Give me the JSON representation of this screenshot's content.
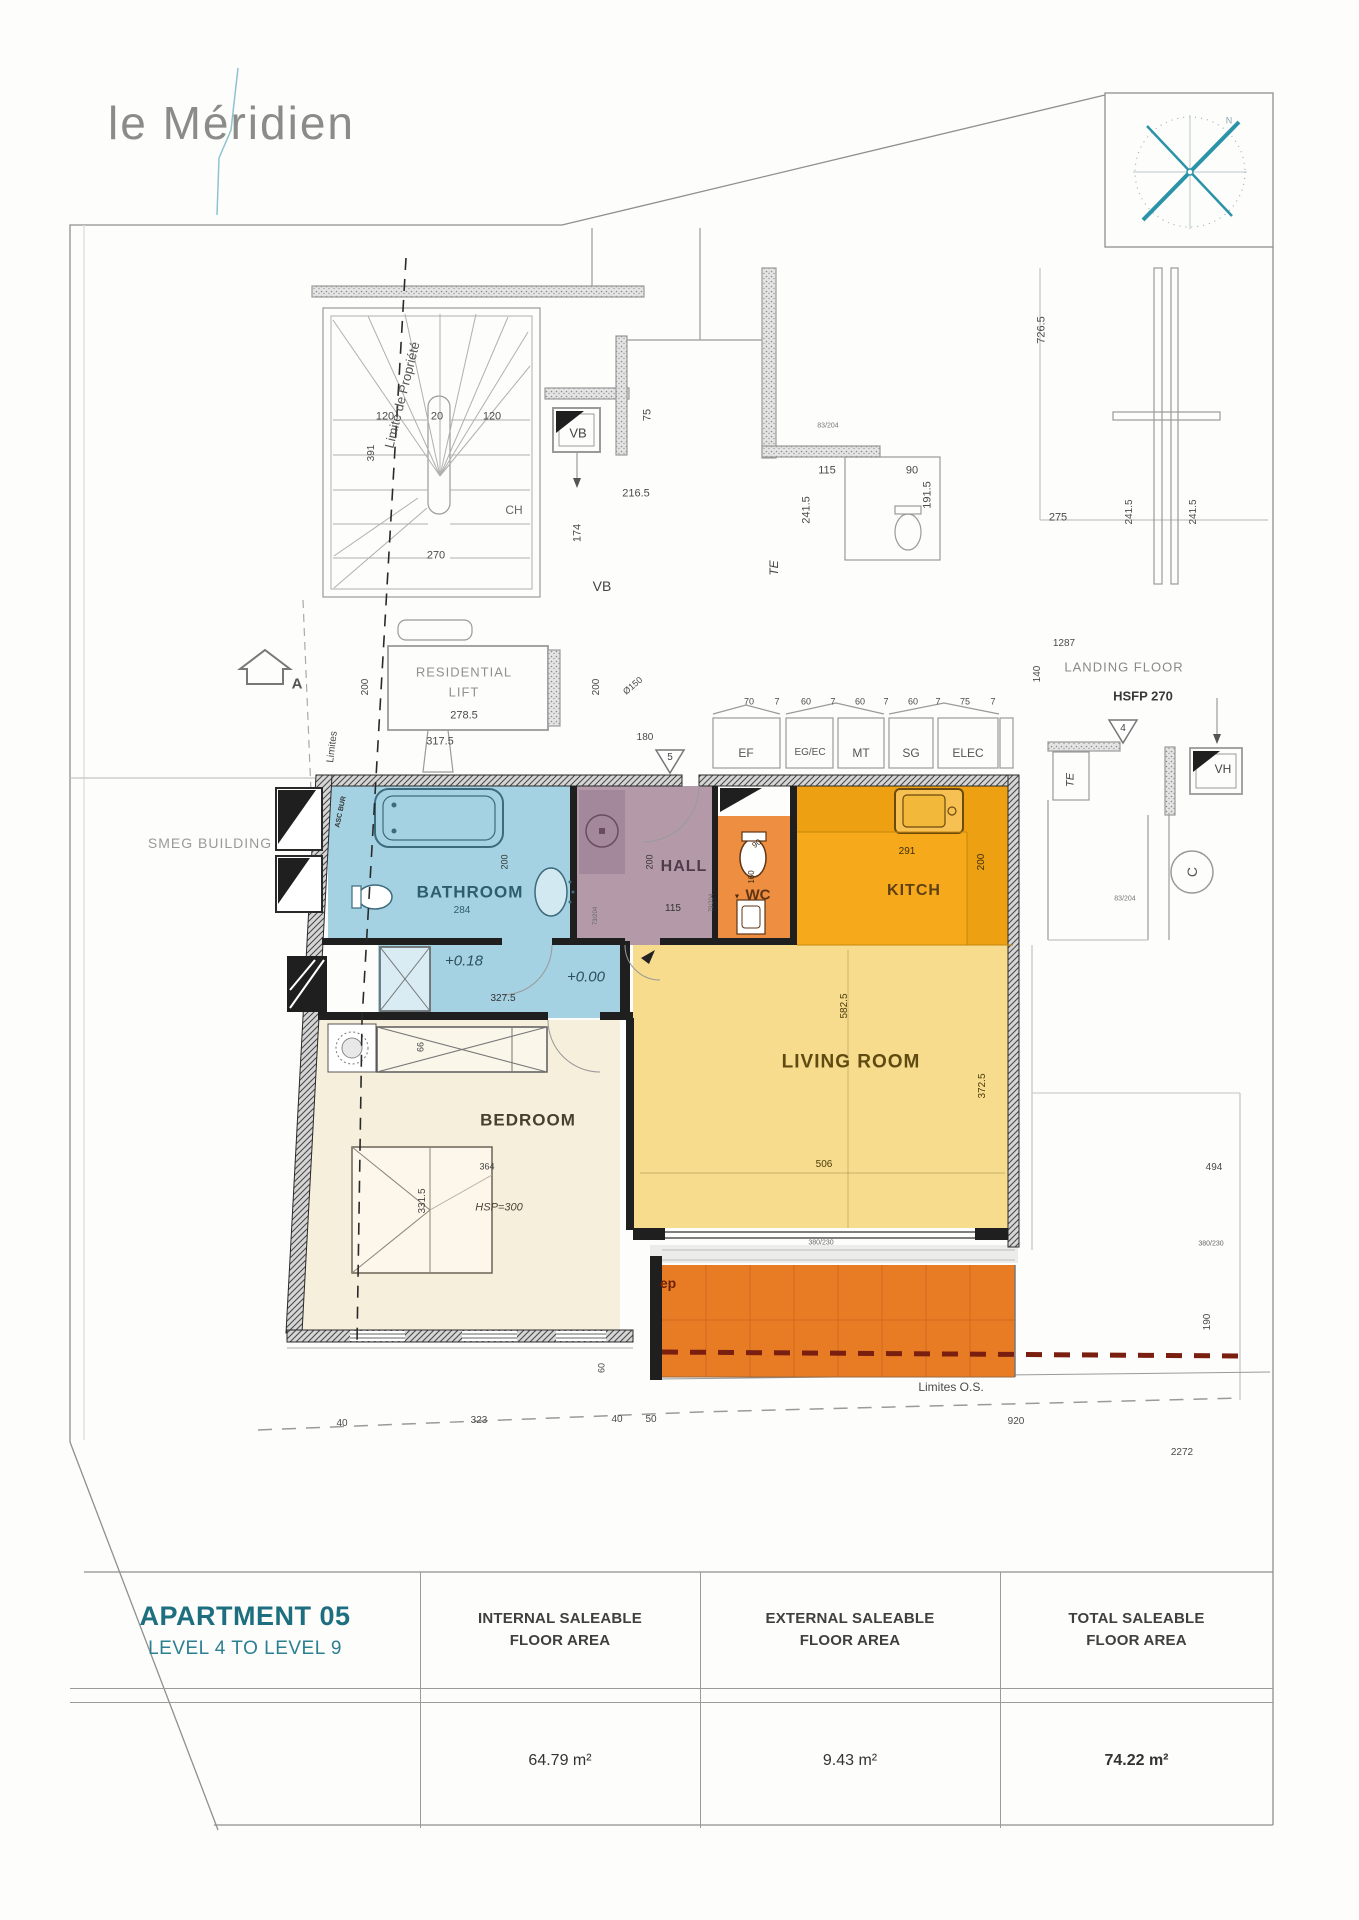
{
  "logo": {
    "text": "le Méridien"
  },
  "compass": {
    "north_label": "N"
  },
  "table": {
    "title": "APARTMENT 05",
    "subtitle": "LEVEL 4 TO LEVEL 9",
    "columns": [
      {
        "header": "INTERNAL SALEABLE FLOOR AREA",
        "value": "64.79 m²"
      },
      {
        "header": "EXTERNAL SALEABLE FLOOR AREA",
        "value": "9.43 m²"
      },
      {
        "header": "TOTAL SALEABLE FLOOR AREA",
        "value": "74.22 m²"
      }
    ]
  },
  "colors": {
    "accent_teal": "#1d6f80",
    "bathroom": "#a4d2e2",
    "hall": "#b49aa9",
    "wc": "#ee8e41",
    "kitchen": "#f6a91a",
    "living": "#f6dc8c",
    "bedroom": "#f6efdc",
    "balcony": "#e87c24"
  },
  "plan": {
    "labels": [
      {
        "t": "N",
        "x": 1229,
        "y": 121,
        "s": 9,
        "c": "#8aa3ab",
        "n": "compass-north-label"
      },
      {
        "t": "Limite de Propriété",
        "x": 402,
        "y": 395,
        "s": 13,
        "r": -76,
        "c": "#555",
        "n": "property-limit-label"
      },
      {
        "t": "120",
        "x": 385,
        "y": 417,
        "s": 11
      },
      {
        "t": "20",
        "x": 437,
        "y": 417,
        "s": 11
      },
      {
        "t": "120",
        "x": 492,
        "y": 417,
        "s": 11
      },
      {
        "t": "391",
        "x": 372,
        "y": 453,
        "s": 10,
        "r": -90
      },
      {
        "t": "270",
        "x": 436,
        "y": 556,
        "s": 11
      },
      {
        "t": "CH",
        "x": 514,
        "y": 510,
        "s": 12,
        "c": "#666"
      },
      {
        "t": "VB",
        "x": 578,
        "y": 433,
        "s": 13,
        "c": "#444"
      },
      {
        "t": "VB",
        "x": 602,
        "y": 586,
        "s": 14,
        "c": "#444"
      },
      {
        "t": "174",
        "x": 578,
        "y": 533,
        "s": 11,
        "r": -90
      },
      {
        "t": "216.5",
        "x": 636,
        "y": 494,
        "s": 11
      },
      {
        "t": "75",
        "x": 648,
        "y": 415,
        "s": 11,
        "r": -90
      },
      {
        "t": "726.5",
        "x": 1042,
        "y": 330,
        "s": 11,
        "r": -90
      },
      {
        "t": "115",
        "x": 827,
        "y": 471,
        "s": 11
      },
      {
        "t": "90",
        "x": 912,
        "y": 471,
        "s": 11
      },
      {
        "t": "191.5",
        "x": 928,
        "y": 495,
        "s": 11,
        "r": -90
      },
      {
        "t": "241.5",
        "x": 807,
        "y": 510,
        "s": 11,
        "r": -90
      },
      {
        "t": "275",
        "x": 1058,
        "y": 518,
        "s": 11
      },
      {
        "t": "241.5",
        "x": 1130,
        "y": 512,
        "s": 10,
        "r": -90
      },
      {
        "t": "241.5",
        "x": 1194,
        "y": 512,
        "s": 10,
        "r": -90
      },
      {
        "t": "83/204",
        "x": 828,
        "y": 426,
        "s": 7,
        "c": "#777"
      },
      {
        "t": "TE",
        "x": 774,
        "y": 568,
        "s": 12,
        "r": -90,
        "i": 1,
        "c": "#444"
      },
      {
        "t": "1287",
        "x": 1064,
        "y": 644,
        "s": 10
      },
      {
        "t": "140",
        "x": 1038,
        "y": 674,
        "s": 10,
        "r": -90
      },
      {
        "t": "LANDING FLOOR",
        "x": 1124,
        "y": 667,
        "s": 13,
        "c": "#8a8a8a",
        "sp": 1,
        "n": "landing-floor-label"
      },
      {
        "t": "HSFP 270",
        "x": 1143,
        "y": 696,
        "s": 13,
        "w": 700,
        "c": "#3a3a3a",
        "n": "hsfp-label"
      },
      {
        "t": "RESIDENTIAL",
        "x": 464,
        "y": 672,
        "s": 13,
        "c": "#909090",
        "sp": 1,
        "n": "residential-lift-label"
      },
      {
        "t": "LIFT",
        "x": 464,
        "y": 692,
        "s": 13,
        "c": "#909090",
        "sp": 1,
        "n": "residential-lift-label"
      },
      {
        "t": "278.5",
        "x": 464,
        "y": 716,
        "s": 11
      },
      {
        "t": "317.5",
        "x": 440,
        "y": 742,
        "s": 11
      },
      {
        "t": "200",
        "x": 366,
        "y": 687,
        "s": 10,
        "r": -90
      },
      {
        "t": "200",
        "x": 597,
        "y": 687,
        "s": 10,
        "r": -90
      },
      {
        "t": "Ø150",
        "x": 633,
        "y": 686,
        "s": 9,
        "r": -40
      },
      {
        "t": "180",
        "x": 645,
        "y": 738,
        "s": 10
      },
      {
        "t": "5",
        "x": 670,
        "y": 758,
        "s": 10,
        "c": "#444"
      },
      {
        "t": "4",
        "x": 1123,
        "y": 729,
        "s": 10,
        "c": "#444"
      },
      {
        "t": "A",
        "x": 297,
        "y": 684,
        "s": 15,
        "w": 700,
        "c": "#555"
      },
      {
        "t": "SMEG BUILDING",
        "x": 210,
        "y": 843,
        "s": 14,
        "c": "#9a9a9a",
        "sp": 1,
        "n": "smeg-building-label"
      },
      {
        "t": "Limites",
        "x": 333,
        "y": 747,
        "s": 10,
        "r": -83
      },
      {
        "t": "70",
        "x": 749,
        "y": 702,
        "s": 9
      },
      {
        "t": "7",
        "x": 777,
        "y": 702,
        "s": 9
      },
      {
        "t": "60",
        "x": 806,
        "y": 702,
        "s": 9
      },
      {
        "t": "7",
        "x": 833,
        "y": 702,
        "s": 9
      },
      {
        "t": "60",
        "x": 860,
        "y": 702,
        "s": 9
      },
      {
        "t": "7",
        "x": 886,
        "y": 702,
        "s": 9
      },
      {
        "t": "60",
        "x": 913,
        "y": 702,
        "s": 9
      },
      {
        "t": "7",
        "x": 938,
        "y": 702,
        "s": 9
      },
      {
        "t": "75",
        "x": 965,
        "y": 702,
        "s": 9
      },
      {
        "t": "7",
        "x": 993,
        "y": 702,
        "s": 9
      },
      {
        "t": "EF",
        "x": 746,
        "y": 753,
        "s": 12,
        "c": "#555",
        "n": "closet-ef-label"
      },
      {
        "t": "EG/EC",
        "x": 810,
        "y": 753,
        "s": 10,
        "c": "#555",
        "n": "closet-egec-label"
      },
      {
        "t": "MT",
        "x": 861,
        "y": 753,
        "s": 12,
        "c": "#555",
        "n": "closet-mt-label"
      },
      {
        "t": "SG",
        "x": 911,
        "y": 753,
        "s": 12,
        "c": "#555",
        "n": "closet-sg-label"
      },
      {
        "t": "ELEC",
        "x": 968,
        "y": 753,
        "s": 12,
        "c": "#555",
        "n": "closet-elec-label"
      },
      {
        "t": "TE",
        "x": 1071,
        "y": 780,
        "s": 11,
        "r": -90,
        "i": 1,
        "c": "#444"
      },
      {
        "t": "VH",
        "x": 1223,
        "y": 769,
        "s": 12,
        "c": "#444"
      },
      {
        "t": "C",
        "x": 1192,
        "y": 872,
        "s": 14,
        "r": -90,
        "c": "#555"
      },
      {
        "t": "83/204",
        "x": 1125,
        "y": 899,
        "s": 7,
        "c": "#777"
      },
      {
        "t": "ASC BUR",
        "x": 341,
        "y": 812,
        "s": 7,
        "r": -78,
        "w": 700,
        "c": "#333"
      },
      {
        "t": "BATHROOM",
        "x": 470,
        "y": 892,
        "s": 17,
        "w": 700,
        "c": "#2e5d6b",
        "sp": 1,
        "n": "room-label-bathroom"
      },
      {
        "t": "284",
        "x": 462,
        "y": 911,
        "s": 10,
        "c": "#2e5d6b"
      },
      {
        "t": "200",
        "x": 505,
        "y": 862,
        "s": 9,
        "r": -90,
        "c": "#333"
      },
      {
        "t": "HALL",
        "x": 684,
        "y": 867,
        "s": 16,
        "w": 700,
        "c": "#4f3c4a",
        "sp": 1,
        "n": "room-label-hall"
      },
      {
        "t": "200",
        "x": 650,
        "y": 862,
        "s": 9,
        "r": -90,
        "c": "#333"
      },
      {
        "t": "115",
        "x": 673,
        "y": 909,
        "s": 10,
        "c": "#333"
      },
      {
        "t": "73/204",
        "x": 596,
        "y": 916,
        "s": 6,
        "r": -90,
        "c": "#666"
      },
      {
        "t": "79/204",
        "x": 712,
        "y": 903,
        "s": 6,
        "r": -90,
        "c": "#666"
      },
      {
        "t": "▼",
        "x": 737,
        "y": 897,
        "s": 7,
        "c": "#4a2a10"
      },
      {
        "t": "WC",
        "x": 758,
        "y": 895,
        "s": 15,
        "w": 700,
        "c": "#5f3414",
        "n": "room-label-wc"
      },
      {
        "t": "90",
        "x": 757,
        "y": 844,
        "s": 8,
        "r": -35,
        "c": "#3a2a10"
      },
      {
        "t": "160",
        "x": 752,
        "y": 877,
        "s": 8,
        "r": -90,
        "c": "#3a2a10"
      },
      {
        "t": "KITCH",
        "x": 914,
        "y": 891,
        "s": 16,
        "w": 700,
        "c": "#5f4012",
        "sp": 1,
        "n": "room-label-kitchen"
      },
      {
        "t": "291",
        "x": 907,
        "y": 852,
        "s": 10,
        "c": "#3f2f08"
      },
      {
        "t": "200",
        "x": 982,
        "y": 862,
        "s": 10,
        "r": -90,
        "c": "#3f2f08"
      },
      {
        "t": "LIVING ROOM",
        "x": 851,
        "y": 1062,
        "s": 19,
        "w": 700,
        "c": "#5f4a12",
        "sp": 1,
        "n": "room-label-living"
      },
      {
        "t": "582.5",
        "x": 845,
        "y": 1006,
        "s": 10,
        "r": -90,
        "c": "#4a3a0c"
      },
      {
        "t": "372.5",
        "x": 983,
        "y": 1086,
        "s": 10,
        "r": -90,
        "c": "#4a3a0c"
      },
      {
        "t": "506",
        "x": 824,
        "y": 1165,
        "s": 10,
        "c": "#4a3a0c"
      },
      {
        "t": "+0.18",
        "x": 464,
        "y": 961,
        "s": 15,
        "i": 1,
        "c": "#2d4f5c",
        "n": "level-018-label"
      },
      {
        "t": "+0.00",
        "x": 586,
        "y": 977,
        "s": 15,
        "i": 1,
        "c": "#2d4f5c",
        "n": "level-000-label"
      },
      {
        "t": "327.5",
        "x": 503,
        "y": 999,
        "s": 10,
        "c": "#333"
      },
      {
        "t": "BEDROOM",
        "x": 528,
        "y": 1120,
        "s": 17,
        "w": 700,
        "c": "#45402f",
        "sp": 1,
        "n": "room-label-bedroom"
      },
      {
        "t": "66",
        "x": 421,
        "y": 1047,
        "s": 9,
        "r": -90,
        "c": "#444"
      },
      {
        "t": "364",
        "x": 487,
        "y": 1167,
        "s": 9,
        "c": "#444"
      },
      {
        "t": "HSP=300",
        "x": 499,
        "y": 1208,
        "s": 11,
        "i": 1,
        "c": "#4a4436"
      },
      {
        "t": "331.5",
        "x": 423,
        "y": 1201,
        "s": 10,
        "r": -90,
        "c": "#444"
      },
      {
        "t": "ep",
        "x": 668,
        "y": 1283,
        "s": 14,
        "w": 700,
        "c": "#6b2208",
        "n": "balcony-ep-label"
      },
      {
        "t": "Limites O.S.",
        "x": 951,
        "y": 1387,
        "s": 12,
        "c": "#4a4a4a",
        "n": "limites-os-label"
      },
      {
        "t": "40",
        "x": 342,
        "y": 1424,
        "s": 10
      },
      {
        "t": "323",
        "x": 479,
        "y": 1421,
        "s": 10
      },
      {
        "t": "40",
        "x": 617,
        "y": 1420,
        "s": 10
      },
      {
        "t": "50",
        "x": 651,
        "y": 1420,
        "s": 10
      },
      {
        "t": "920",
        "x": 1016,
        "y": 1422,
        "s": 10
      },
      {
        "t": "60",
        "x": 602,
        "y": 1368,
        "s": 9,
        "r": -90
      },
      {
        "t": "494",
        "x": 1214,
        "y": 1168,
        "s": 10
      },
      {
        "t": "380/230",
        "x": 821,
        "y": 1243,
        "s": 7,
        "c": "#666"
      },
      {
        "t": "380/230",
        "x": 1211,
        "y": 1244,
        "s": 7,
        "c": "#666"
      },
      {
        "t": "190",
        "x": 1208,
        "y": 1322,
        "s": 10,
        "r": -90
      },
      {
        "t": "2272",
        "x": 1182,
        "y": 1453,
        "s": 10
      }
    ]
  }
}
